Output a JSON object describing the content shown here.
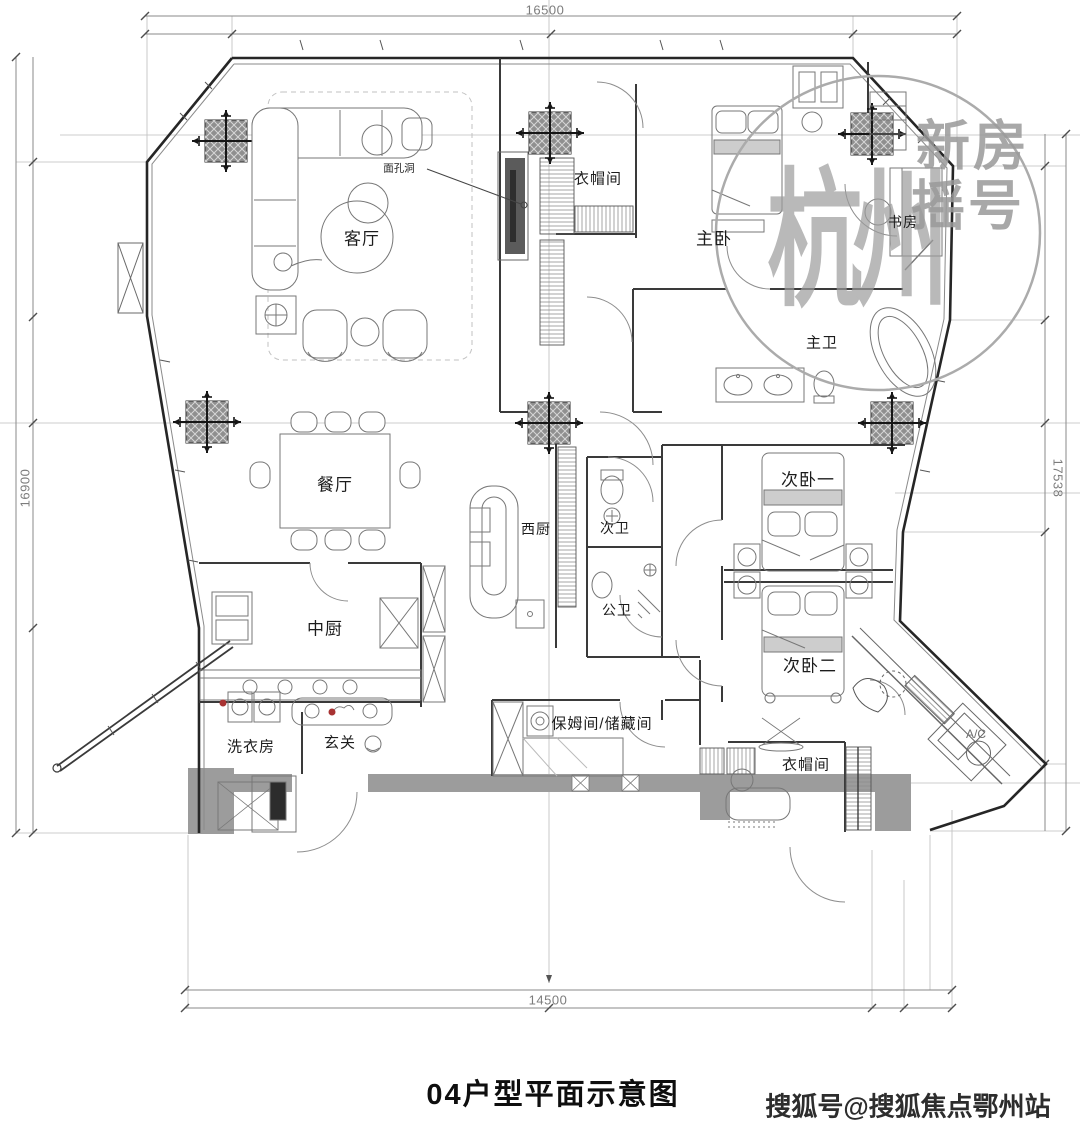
{
  "title": "04户型平面示意图",
  "footer_watermark": "搜狐号@搜狐焦点鄂州站",
  "stamp": {
    "logo": "杭州",
    "word1": "新房",
    "word2": "摇号"
  },
  "dimensions": {
    "top": "16500",
    "bottom": "14500",
    "left": "16900",
    "right": "17538"
  },
  "annotations": {
    "wall_hole": "面孔洞"
  },
  "rooms": {
    "living": "客厅",
    "cloak_top": "衣帽间",
    "master_bedroom": "主卧",
    "study": "书房",
    "master_bath": "主卫",
    "dining": "餐厅",
    "west_kitchen": "西厨",
    "second_bath": "次卫",
    "public_bath": "公卫",
    "second_bedroom_1": "次卧一",
    "second_bedroom_2": "次卧二",
    "chinese_kitchen": "中厨",
    "laundry": "洗衣房",
    "foyer": "玄关",
    "nanny_storage": "保姆间/储藏间",
    "cloak_bottom": "衣帽间",
    "ac": "A/C"
  }
}
